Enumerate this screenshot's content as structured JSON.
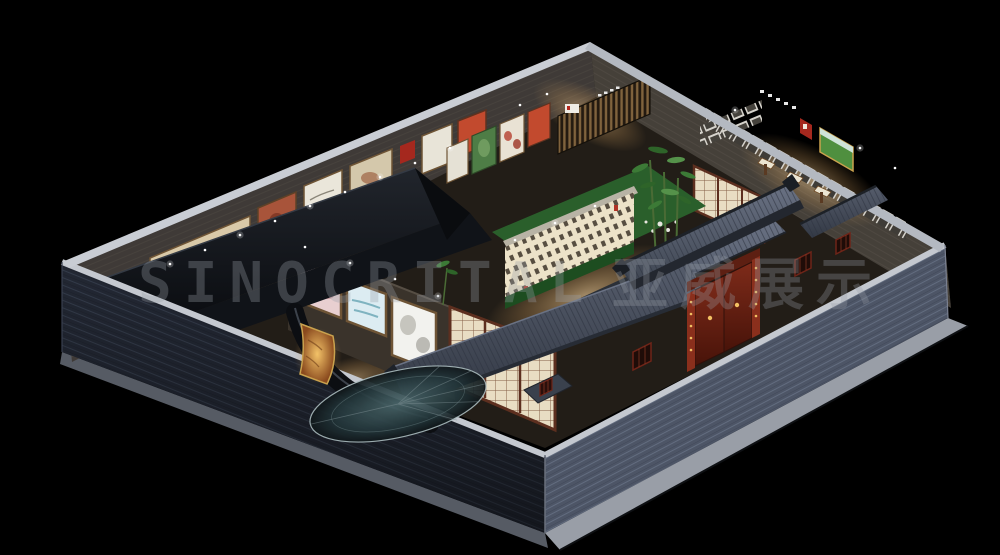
{
  "image": {
    "kind": "3d-architectural-render",
    "subject": "isometric cutaway of a Chinese courtyard-style exhibition hall at night",
    "background": "#000000"
  },
  "watermark": {
    "latin": "SINOCRITAL",
    "cjk": "亚威展示"
  },
  "colors": {
    "background": "#000000",
    "exterior_brick_shadow": "#232834",
    "exterior_brick_lit": "#4d5566",
    "coping": "#c4c8cf",
    "sidewalk": "#999ea7",
    "interior_floor": "#221d17",
    "roof_slate": "#555d6e",
    "roof_dark": "#12151b",
    "shoji_paper": "#e8ddc3",
    "shoji_frame": "#5d2f1f",
    "door_red": "#6e2418",
    "pillar_red": "#8a2f1c",
    "accent_red": "#a5281e",
    "lantern_gold": "#f2c063",
    "lawn": "#2a5f2b",
    "hedge": "#1d4d20",
    "calligraphy_wall": "#ece2c8",
    "bamboo": "#3c7a36",
    "glass_teal": "#3a565a",
    "panel_pink": "#e8cfd0",
    "panel_blue": "#dcecf2",
    "panel_white": "#f2f2ee",
    "panel_green": "#4e7d46",
    "panel_orange": "#c24a2e",
    "mural_beige": "#d9c9a8",
    "watermark": "#9aa0a8"
  }
}
